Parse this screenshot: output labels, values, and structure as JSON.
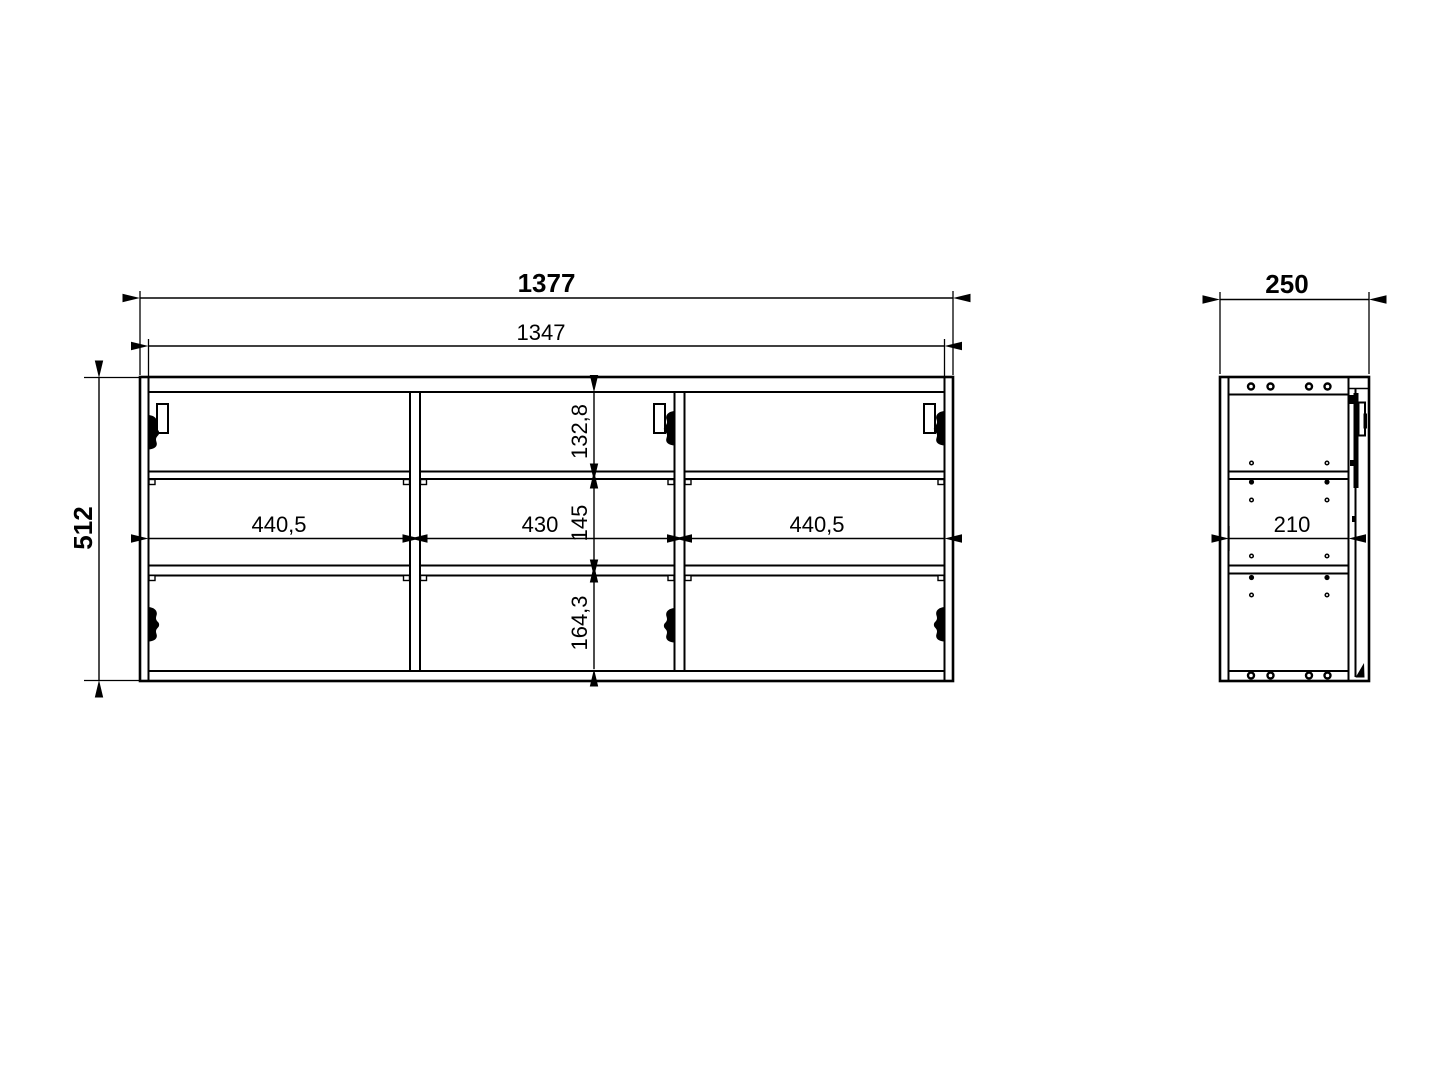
{
  "drawing": {
    "type": "furniture technical drawing",
    "views": {
      "front": {
        "name": "front-view",
        "dimensions": {
          "overall_width": "1377",
          "inner_width": "1347",
          "overall_height": "512",
          "left_section_width": "440,5",
          "middle_section_width": "430",
          "right_section_width": "440,5",
          "top_section_height": "132,8",
          "middle_section_height": "145",
          "bottom_section_height": "164,3"
        }
      },
      "side": {
        "name": "side-view",
        "dimensions": {
          "overall_depth": "250",
          "inner_depth": "210"
        }
      }
    },
    "colors": {
      "line": "#000000",
      "background": "#ffffff"
    }
  }
}
